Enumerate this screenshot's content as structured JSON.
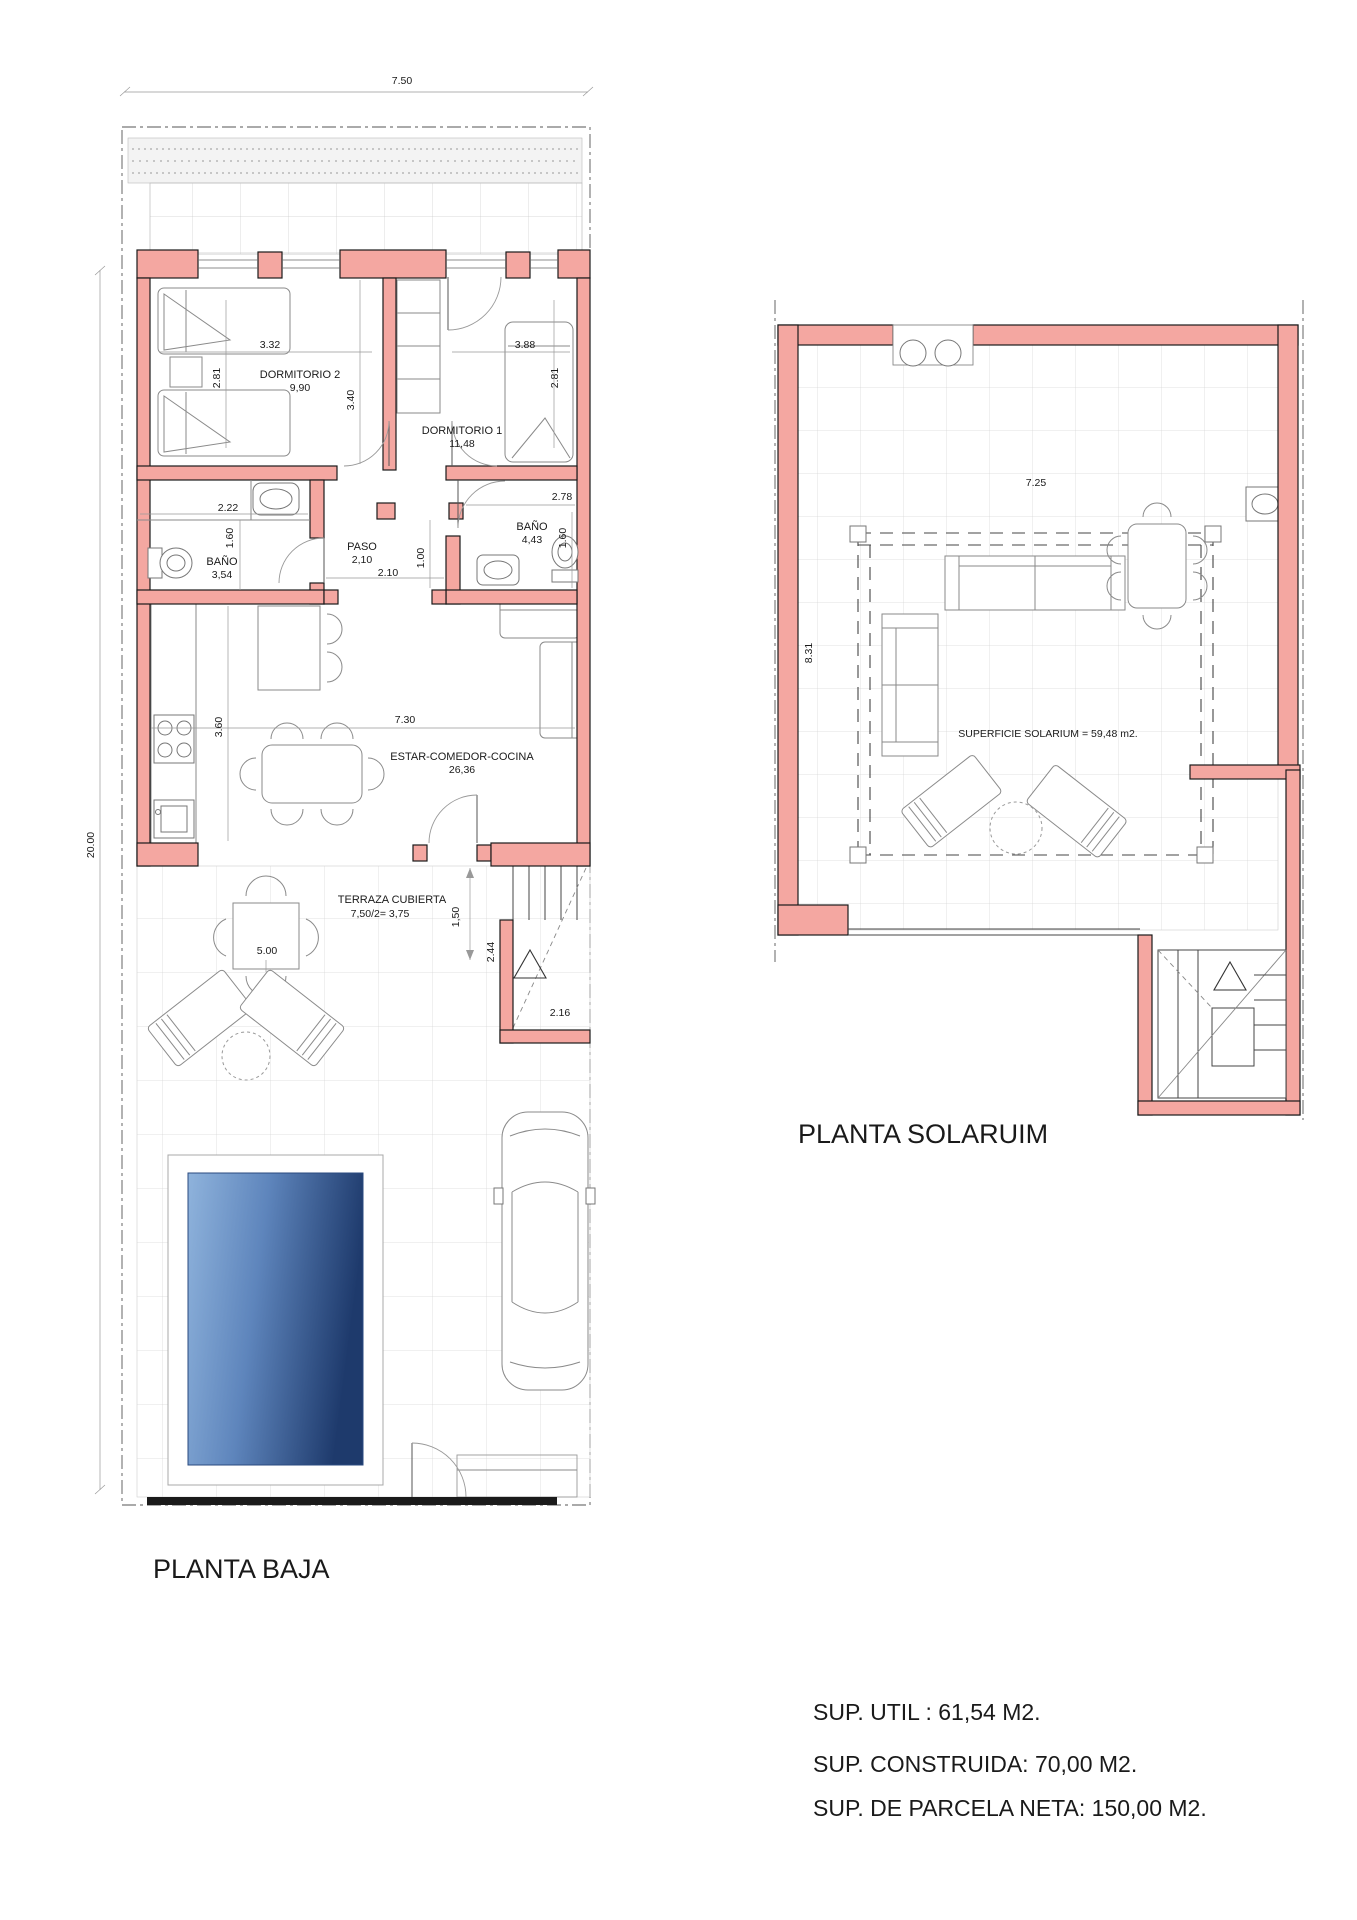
{
  "colors": {
    "wall_fill": "#F4A7A1",
    "wall_stroke": "#1a1a1a",
    "pool_light": "#8FB3DC",
    "pool_dark": "#1E3A6C"
  },
  "ground_floor": {
    "title": "PLANTA BAJA",
    "dim_width": "7.50",
    "dim_height": "20.00",
    "rooms": {
      "dorm2": {
        "name": "DORMITORIO 2",
        "area": "9,90",
        "dim_w": "3.32",
        "dim_h": "2.81"
      },
      "dorm1": {
        "name": "DORMITORIO 1",
        "area": "11,48",
        "dim_w": "3.88",
        "dim_h": "2.81",
        "dim_depth": "3.40"
      },
      "bath1": {
        "name": "BAÑO",
        "area": "3,54",
        "dim_w": "2.22",
        "dim_h": "1.60"
      },
      "paso": {
        "name": "PASO",
        "area": "2,10",
        "dim_w": "2.10",
        "dim_h": "1.00"
      },
      "bath2": {
        "name": "BAÑO",
        "area": "4,43",
        "dim_w": "2.78",
        "dim_h": "1.60"
      },
      "living": {
        "name": "ESTAR-COMEDOR-COCINA",
        "area": "26,36",
        "dim_w": "7.30",
        "dim_h": "3.60"
      },
      "terrace": {
        "name": "TERRAZA CUBIERTA",
        "area": "7,50/2= 3,75",
        "dim_w": "5.00",
        "dim_h": "1,50"
      },
      "stairs": {
        "dim_w": "2.16",
        "dim_h": "2.44"
      }
    }
  },
  "solarium": {
    "title": "PLANTA SOLARUIM",
    "surface_label": "SUPERFICIE SOLARIUM = 59,48 m2.",
    "dim_width": "7.25",
    "dim_height": "8.31"
  },
  "summary": {
    "line1": "SUP. UTIL : 61,54 M2.",
    "line2": "SUP. CONSTRUIDA: 70,00 M2.",
    "line3": "SUP. DE PARCELA NETA: 150,00 M2."
  }
}
